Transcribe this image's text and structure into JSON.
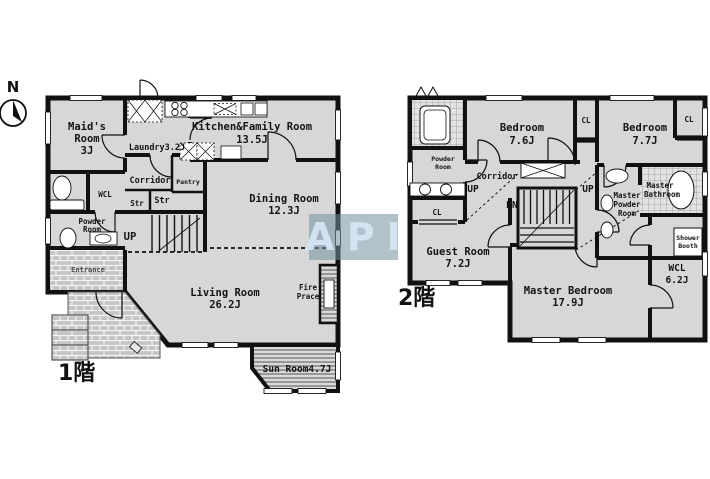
{
  "compass": {
    "north_label": "N"
  },
  "watermark": {
    "text": "API"
  },
  "floor1": {
    "floor_label": "1階",
    "rooms": {
      "maids": {
        "l1": "Maid's",
        "l2": "Room",
        "l3": "3J"
      },
      "laundry": {
        "l1": "Laundry3.2J"
      },
      "kitchen": {
        "l1": "Kitchen&Family Room",
        "l2": "13.5J"
      },
      "corridor": {
        "l1": "Corridor"
      },
      "pantry": {
        "l1": "Pantry"
      },
      "str1": {
        "l1": "Str"
      },
      "str2": {
        "l1": "Str"
      },
      "wcl": {
        "l1": "WCL"
      },
      "powder": {
        "l1": "Powder",
        "l2": "Room"
      },
      "dining": {
        "l1": "Dining Room",
        "l2": "12.3J"
      },
      "stairs_up": {
        "l1": "UP"
      },
      "entrance": {
        "l1": "Entrance"
      },
      "living": {
        "l1": "Living Room",
        "l2": "26.2J"
      },
      "fireplace": {
        "l1": "Fire",
        "l2": "Prace"
      },
      "sunroom": {
        "l1": "Sun Room4.7J"
      }
    }
  },
  "floor2": {
    "floor_label": "2階",
    "rooms": {
      "powder": {
        "l1": "Powder",
        "l2": "Room"
      },
      "bedroom1": {
        "l1": "Bedroom",
        "l2": "7.6J"
      },
      "cl1": {
        "l1": "CL"
      },
      "bedroom2": {
        "l1": "Bedroom",
        "l2": "7.7J"
      },
      "cl2": {
        "l1": "CL"
      },
      "corridor": {
        "l1": "Corridor"
      },
      "up1": {
        "l1": "UP"
      },
      "dn": {
        "l1": "DN"
      },
      "up2": {
        "l1": "UP"
      },
      "master_powder": {
        "l1": "Master",
        "l2": "Powder",
        "l3": "Room"
      },
      "master_bath": {
        "l1": "Master",
        "l2": "Bathroom"
      },
      "shower": {
        "l1": "Shower",
        "l2": "Booth"
      },
      "cl3": {
        "l1": "CL"
      },
      "guest": {
        "l1": "Guest Room",
        "l2": "7.2J"
      },
      "master_bedroom": {
        "l1": "Master Bedroom",
        "l2": "17.9J"
      },
      "wcl": {
        "l1": "WCL",
        "l2": "6.2J"
      }
    }
  }
}
